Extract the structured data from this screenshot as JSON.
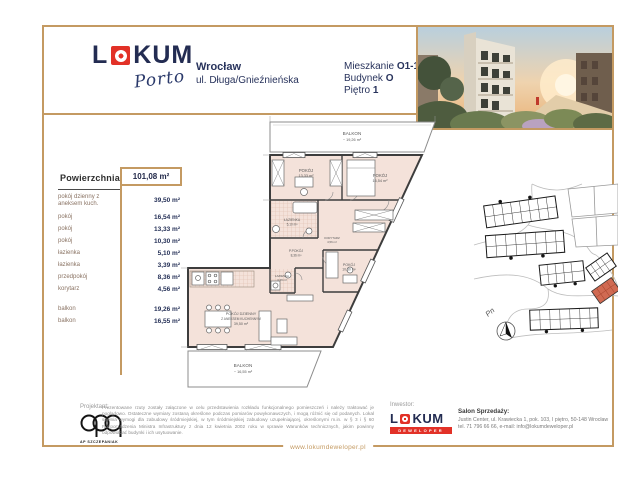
{
  "header": {
    "brand": "LOKUM",
    "brand_sub": "Porto",
    "city": "Wrocław",
    "street": "ul. Długa/Gnieźnieńska",
    "unit": [
      {
        "label": "Mieszkanie ",
        "value": "O1-1-2"
      },
      {
        "label": "Budynek ",
        "value": "O"
      },
      {
        "label": "Piętro ",
        "value": "1"
      }
    ]
  },
  "area_table": {
    "title": "Powierzchnia",
    "total": "101,08 m²",
    "rows": [
      {
        "label": "pokój dzienny z aneksem kuch.",
        "value": "39,50 m²"
      },
      {
        "label": "pokój",
        "value": "16,54 m²"
      },
      {
        "label": "pokój",
        "value": "13,33 m²"
      },
      {
        "label": "pokój",
        "value": "10,30 m²"
      },
      {
        "label": "łazienka",
        "value": "5,10 m²"
      },
      {
        "label": "łazienka",
        "value": "3,39 m²"
      },
      {
        "label": "przedpokój",
        "value": "8,36 m²"
      },
      {
        "label": "korytarz",
        "value": "4,56 m²"
      },
      {
        "label": "balkon",
        "value": "19,26 m²"
      },
      {
        "label": "balkon",
        "value": "16,55 m²"
      }
    ]
  },
  "floor_plan": {
    "balcony_top": {
      "name": "BALKON",
      "area": "~ 19,26 m²"
    },
    "balcony_bottom": {
      "name": "BALKON",
      "area": "~ 16,55 m²"
    },
    "rooms": [
      {
        "name": "POKÓJ",
        "area": "13,33 m²"
      },
      {
        "name": "POKÓJ",
        "area": "16,54 m²"
      },
      {
        "name": "ŁAZIENKA",
        "area": "5,10 m²"
      },
      {
        "name": "KORYTARZ",
        "area": "4,56 m²"
      },
      {
        "name": "P.POKÓJ",
        "area": "8,36 m²"
      },
      {
        "name": "POKÓJ",
        "area": "10,30 m²"
      },
      {
        "name": "ŁAZIENKA",
        "area": "3,39 m²"
      },
      {
        "name": "POKÓJ DZIENNY",
        "name2": "Z ANEKSEM KUCHENNYM",
        "area": "39,50 m²"
      }
    ]
  },
  "site_plan": {
    "compass": "Pn"
  },
  "footer": {
    "designer_label": "Projektant:",
    "designer_name": "AP SZCZEPANIAK",
    "disclaimer": "Prezentowane rzuty zostały załączone w celu przedstawienia rozkładu funkcjonalnego pomieszczeń i należy traktować je poglądowo. Ostateczne wymiary zostaną określone podczas pomiarów powykonawczych, i mogą różnić się od podanych. Lokal spełnia wymogi dla zabudowy śródmiejskiej, w tym śródmiejskiej zabudowy uzupełniającej, określonymi m.in. w § 3 i § 60 Rozporządzenia Ministra Infrastruktury z dnia 12 kwietnia 2002 roku w sprawie Warunków technicznych, jakim powinny odpowiadać budynki i ich usytuowanie.",
    "investor_label": "Inwestor:",
    "investor_brand": "LOKUM",
    "investor_brand_sub": "DEWELOPER",
    "sales_title": "Salon Sprzedaży:",
    "sales_address": "Justin Center, ul. Krawiecka 1, pok. 103, I piętro, 50-148 Wrocław",
    "sales_contact": "tel. 71 796 66 66, e-mail: info@lokumdeweloper.pl",
    "website": "www.lokumdeweloper.pl"
  },
  "colors": {
    "accent_gold": "#c49a62",
    "brand_navy": "#232c52",
    "brand_red": "#e23127",
    "plan_fill": "#f4e2da",
    "highlight_building": "#d06a52"
  }
}
